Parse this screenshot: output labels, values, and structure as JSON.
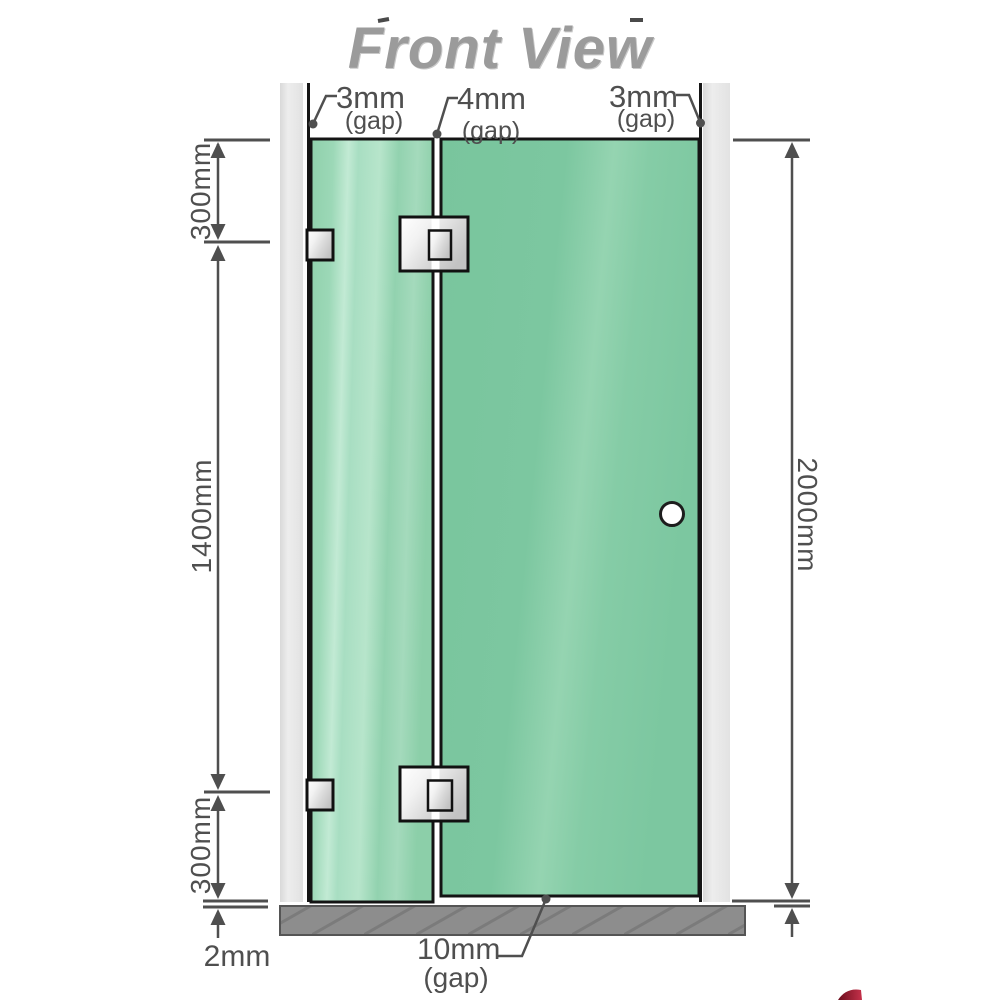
{
  "title": "Front View",
  "top_gaps": [
    {
      "value": "3mm",
      "label": "(gap)"
    },
    {
      "value": "4mm",
      "label": "(gap)"
    },
    {
      "value": "3mm",
      "label": "(gap)"
    }
  ],
  "dims": {
    "left_top": "300mm",
    "left_middle": "1400mm",
    "left_bottom": "300mm",
    "right_full": "2000mm",
    "floor_offset": "2mm",
    "bottom_gap": {
      "value": "10mm",
      "label": "(gap)"
    }
  },
  "colors": {
    "glass_green": "#7cc7a0",
    "glass_highlight": "#c2ead4",
    "panel_border": "#141414",
    "wall_gray": "#e7e7e7",
    "floor_gray": "#8d8d8d",
    "dimension_gray": "#4f4f4f",
    "title_gray": "#9b9b9b",
    "hinge_metal": "#e0e0e0",
    "watermark_red": "#a01f30"
  }
}
